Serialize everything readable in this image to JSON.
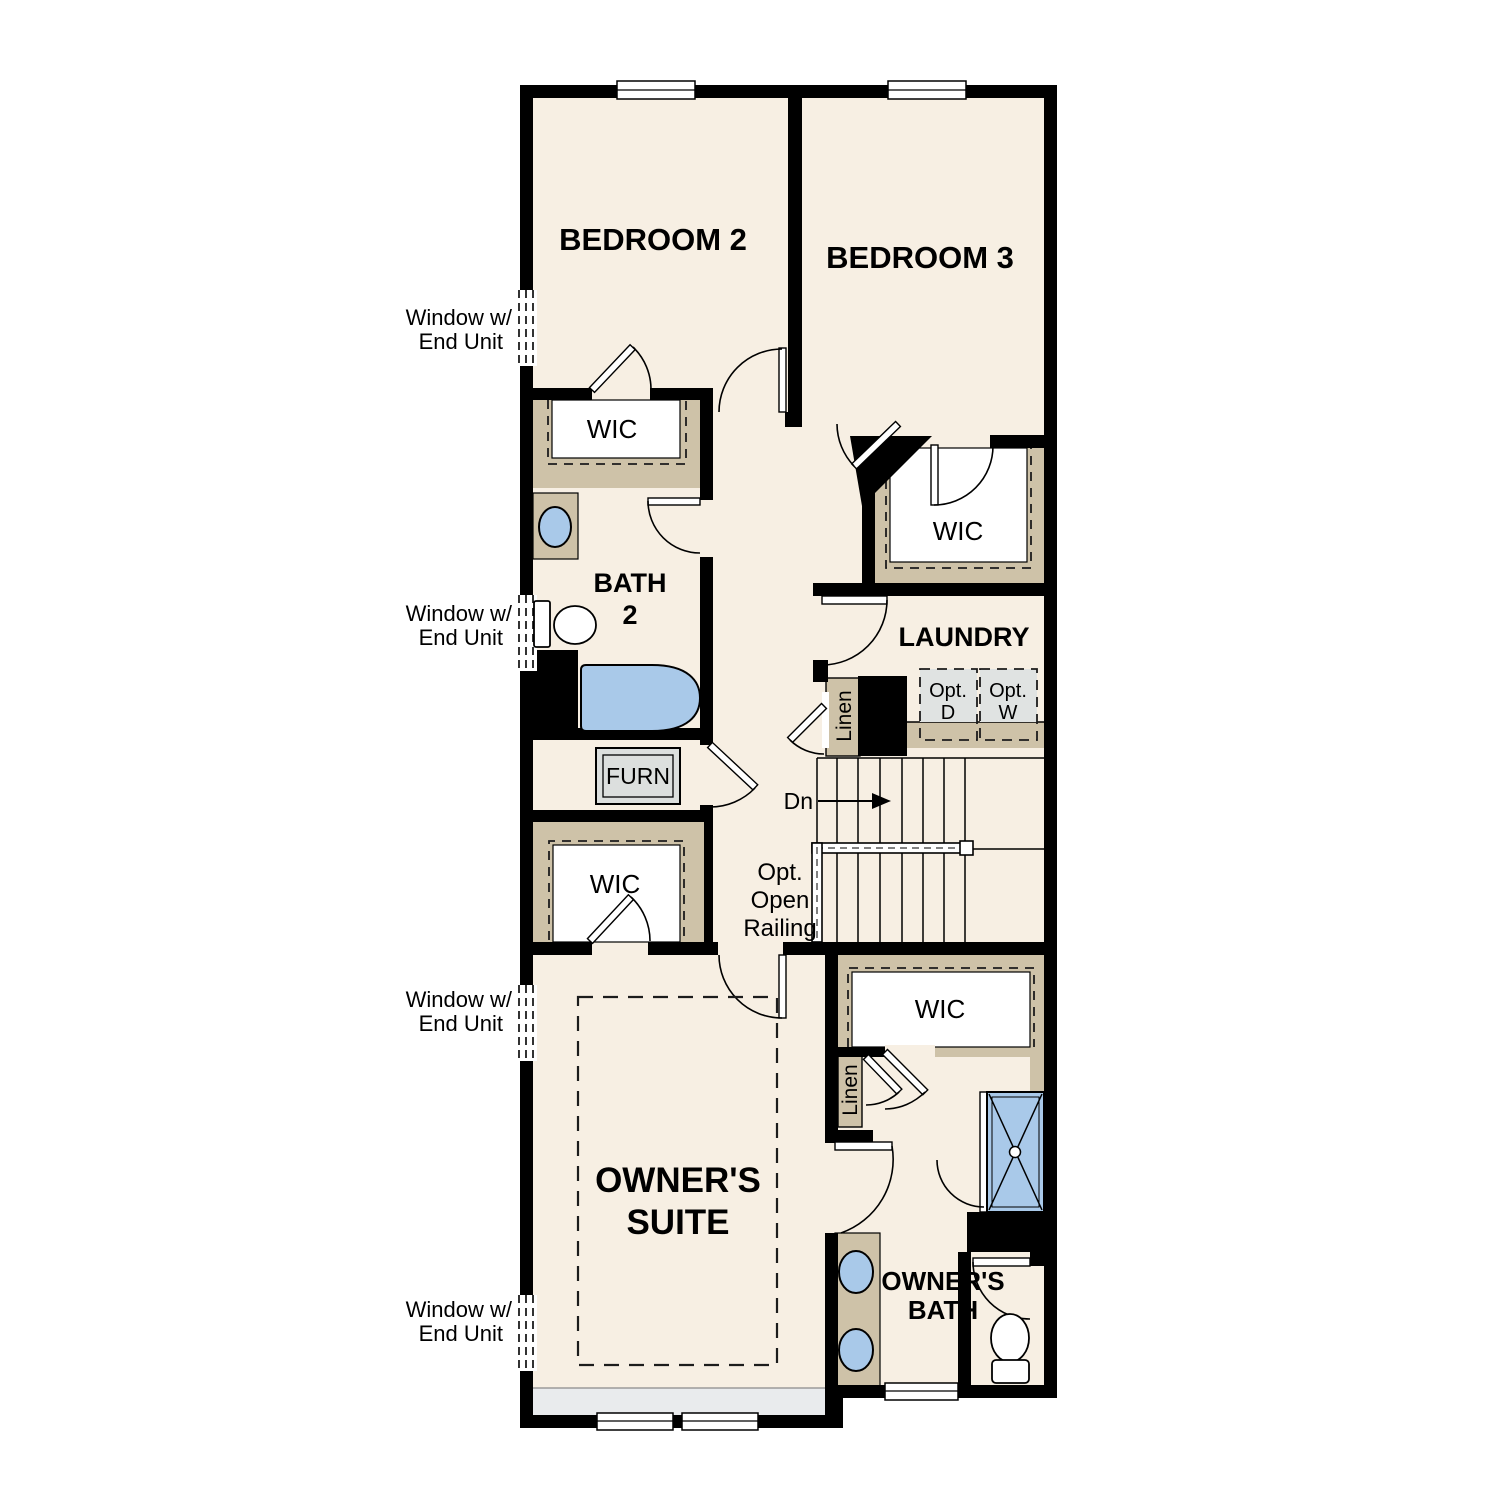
{
  "colors": {
    "floor": "#f7efe3",
    "wall": "#000000",
    "closet_shelving": "#cec2a8",
    "fixture_blue": "#a9c9e9",
    "appliance_gray": "#e0e3e2",
    "furnace_gray": "#dcdfde",
    "bottom_strip_gray": "#e9ebed"
  },
  "rooms": {
    "bedroom2": "BEDROOM 2",
    "bedroom3": "BEDROOM 3",
    "bath2": [
      "BATH",
      "2"
    ],
    "laundry": "LAUNDRY",
    "owners_suite": [
      "OWNER'S",
      "SUITE"
    ],
    "owners_bath": [
      "OWNER'S",
      "BATH"
    ],
    "wic": "WIC",
    "furnace": "FURN",
    "linen": "Linen"
  },
  "labels": {
    "opt_dryer": [
      "Opt.",
      "D"
    ],
    "opt_washer": [
      "Opt.",
      "W"
    ],
    "stairs_down": "Dn",
    "opt_open_railing": [
      "Opt.",
      "Open",
      "Railing"
    ],
    "window_end_unit": [
      "Window w/",
      "End Unit"
    ]
  }
}
